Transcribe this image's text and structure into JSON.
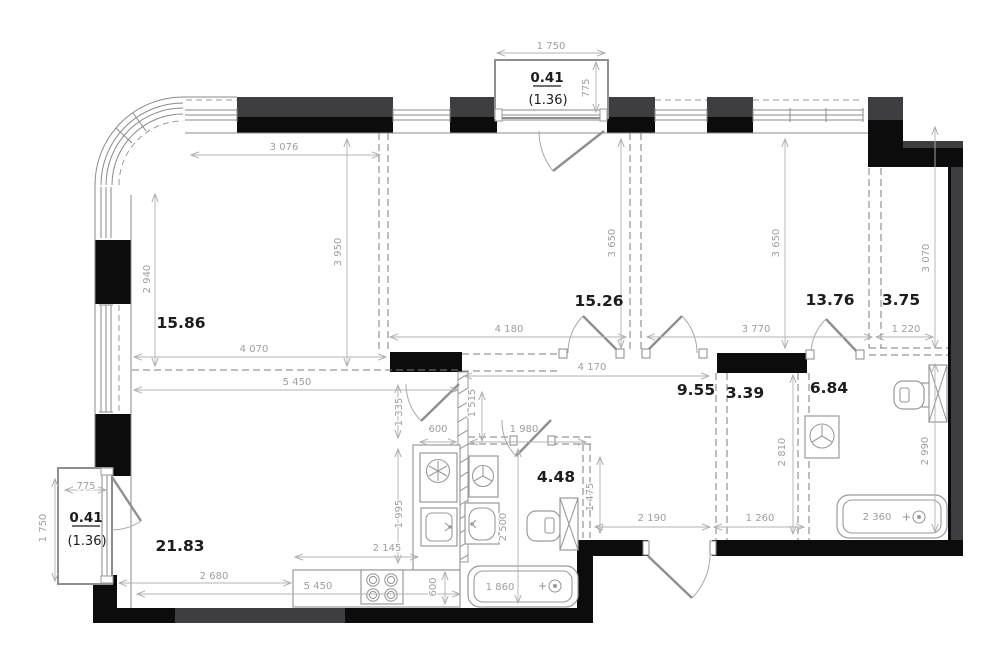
{
  "drawing_type": "apartment-floor-plan",
  "rooms": [
    {
      "name": "room-top-left",
      "area": "15.86"
    },
    {
      "name": "room-top-center",
      "area": "15.26"
    },
    {
      "name": "room-top-right",
      "area": "13.76"
    },
    {
      "name": "wardrobe-right",
      "area": "3.75"
    },
    {
      "name": "corridor",
      "area": "9.55"
    },
    {
      "name": "closet",
      "area": "3.39"
    },
    {
      "name": "bathroom-right",
      "area": "6.84"
    },
    {
      "name": "bathroom-center",
      "area": "4.48"
    },
    {
      "name": "kitchen-living-room",
      "area": "21.83"
    }
  ],
  "balconies": {
    "top": {
      "area": "0.41",
      "area_full": "(1.36)"
    },
    "left": {
      "area": "0.41",
      "area_full": "(1.36)"
    }
  },
  "dims": [
    "1 750",
    "775",
    "3 076",
    "2 940",
    "3 950",
    "4 070",
    "5 450",
    "4 180",
    "4 170",
    "3 650",
    "3 650",
    "3 770",
    "1 220",
    "3 070",
    "1 335",
    "1 515",
    "600",
    "1 980",
    "1 995",
    "2 500",
    "1 475",
    "2 810",
    "2 990",
    "2 190",
    "1 260",
    "2 145",
    "2 680",
    "5 450",
    "600",
    "1 860",
    "2 360",
    "775",
    "1 750"
  ]
}
